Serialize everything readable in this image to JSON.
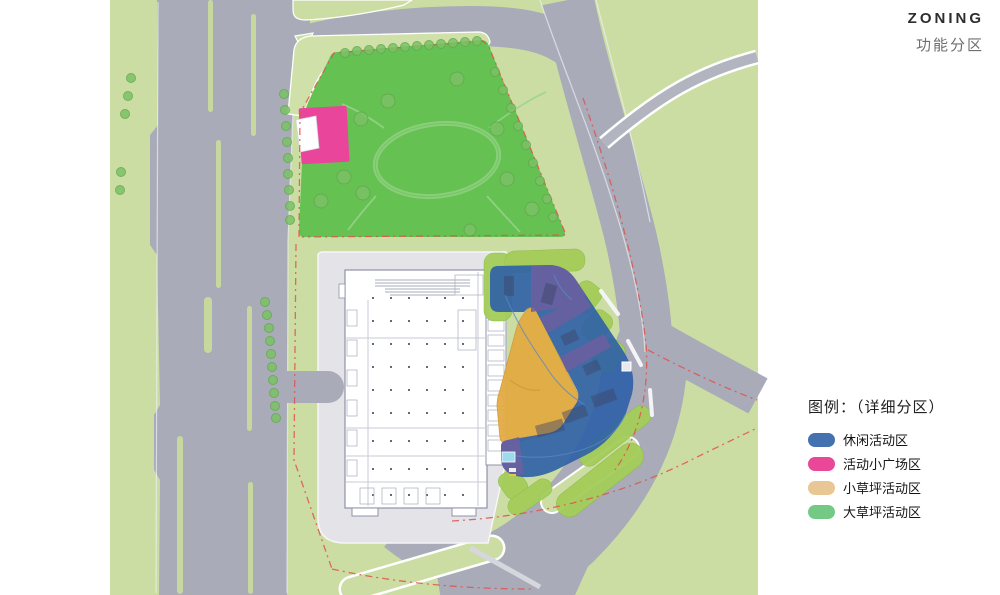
{
  "header": {
    "title": "ZONING",
    "subtitle": "功能分区"
  },
  "legend": {
    "title": "图例：（详细分区）",
    "items": [
      {
        "label": "休闲活动区",
        "color": "#4472b0"
      },
      {
        "label": "活动小广场区",
        "color": "#ea4798"
      },
      {
        "label": "小草坪活动区",
        "color": "#e9c795"
      },
      {
        "label": "大草坪活动区",
        "color": "#74c984"
      }
    ]
  },
  "palette": {
    "road": "#a9abb8",
    "background_green": "#ccdda3",
    "park_green": "#5ebf4e",
    "plaza_gray": "#e3e3e8",
    "leisure_blue": "#2e5fa7",
    "plaza_pink": "#e8459b",
    "small_lawn_orange": "#e3ab43",
    "accent_purple": "#6d5f9f",
    "boundary_red": "#e0544e",
    "lawn_bright": "#a4cd59",
    "pool_cyan": "#9ed9ec"
  }
}
